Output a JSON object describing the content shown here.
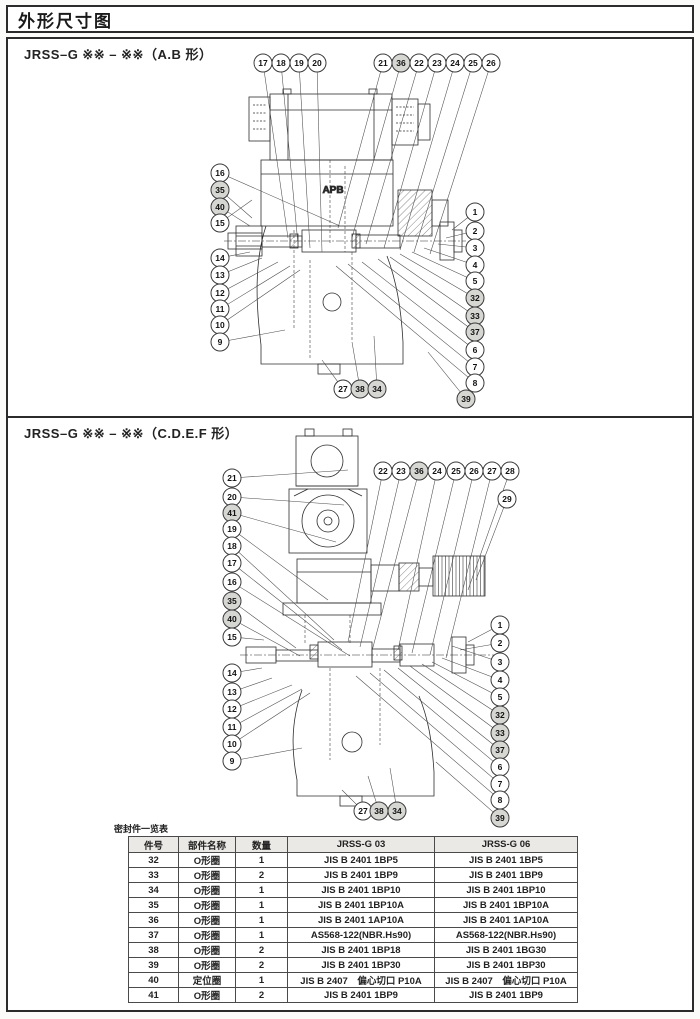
{
  "page_title": "外形尺寸图",
  "sections": [
    {
      "heading": "JRSS–G ※※ – ※※（A.B 形）",
      "drawing_label": "APB",
      "callouts": [
        {
          "n": "17",
          "x": 263,
          "y": 63,
          "tx": 288,
          "ty": 238
        },
        {
          "n": "18",
          "x": 281,
          "y": 63,
          "tx": 298,
          "ty": 244
        },
        {
          "n": "19",
          "x": 299,
          "y": 63,
          "tx": 310,
          "ty": 248
        },
        {
          "n": "20",
          "x": 317,
          "y": 63,
          "tx": 322,
          "ty": 252
        },
        {
          "n": "21",
          "x": 383,
          "y": 63,
          "tx": 338,
          "ty": 228
        },
        {
          "n": "36",
          "x": 401,
          "y": 63,
          "tx": 352,
          "ty": 238,
          "s": true
        },
        {
          "n": "22",
          "x": 419,
          "y": 63,
          "tx": 366,
          "ty": 244
        },
        {
          "n": "23",
          "x": 437,
          "y": 63,
          "tx": 384,
          "ty": 248
        },
        {
          "n": "24",
          "x": 455,
          "y": 63,
          "tx": 400,
          "ty": 250
        },
        {
          "n": "25",
          "x": 473,
          "y": 63,
          "tx": 414,
          "ty": 252
        },
        {
          "n": "26",
          "x": 491,
          "y": 63,
          "tx": 430,
          "ty": 254
        },
        {
          "n": "16",
          "x": 220,
          "y": 173,
          "tx": 340,
          "ty": 226
        },
        {
          "n": "35",
          "x": 220,
          "y": 190,
          "tx": 252,
          "ty": 218,
          "s": true
        },
        {
          "n": "40",
          "x": 220,
          "y": 207,
          "tx": 250,
          "ty": 226,
          "s": true
        },
        {
          "n": "15",
          "x": 220,
          "y": 223,
          "tx": 252,
          "ty": 200
        },
        {
          "n": "14",
          "x": 220,
          "y": 258,
          "tx": 250,
          "ty": 252
        },
        {
          "n": "13",
          "x": 220,
          "y": 275,
          "tx": 262,
          "ty": 258
        },
        {
          "n": "12",
          "x": 220,
          "y": 293,
          "tx": 278,
          "ty": 262
        },
        {
          "n": "11",
          "x": 220,
          "y": 309,
          "tx": 290,
          "ty": 266
        },
        {
          "n": "10",
          "x": 220,
          "y": 325,
          "tx": 300,
          "ty": 270
        },
        {
          "n": "9",
          "x": 220,
          "y": 342,
          "tx": 285,
          "ty": 330
        },
        {
          "n": "1",
          "x": 475,
          "y": 212,
          "tx": 452,
          "ty": 230
        },
        {
          "n": "2",
          "x": 475,
          "y": 231,
          "tx": 446,
          "ty": 238
        },
        {
          "n": "3",
          "x": 475,
          "y": 248,
          "tx": 438,
          "ty": 244
        },
        {
          "n": "4",
          "x": 475,
          "y": 265,
          "tx": 424,
          "ty": 248
        },
        {
          "n": "5",
          "x": 475,
          "y": 281,
          "tx": 412,
          "ty": 252
        },
        {
          "n": "32",
          "x": 475,
          "y": 298,
          "tx": 400,
          "ty": 254,
          "s": true
        },
        {
          "n": "33",
          "x": 475,
          "y": 316,
          "tx": 390,
          "ty": 257,
          "s": true
        },
        {
          "n": "37",
          "x": 475,
          "y": 332,
          "tx": 378,
          "ty": 259,
          "s": true
        },
        {
          "n": "6",
          "x": 475,
          "y": 350,
          "tx": 362,
          "ty": 262
        },
        {
          "n": "7",
          "x": 475,
          "y": 367,
          "tx": 348,
          "ty": 264
        },
        {
          "n": "8",
          "x": 475,
          "y": 383,
          "tx": 336,
          "ty": 266
        },
        {
          "n": "39",
          "x": 466,
          "y": 399,
          "tx": 428,
          "ty": 352,
          "s": true
        },
        {
          "n": "27",
          "x": 343,
          "y": 389,
          "tx": 322,
          "ty": 360
        },
        {
          "n": "38",
          "x": 360,
          "y": 389,
          "tx": 352,
          "ty": 342,
          "s": true
        },
        {
          "n": "34",
          "x": 377,
          "y": 389,
          "tx": 374,
          "ty": 336,
          "s": true
        }
      ]
    },
    {
      "heading": "JRSS–G ※※ – ※※（C.D.E.F 形）",
      "callouts": [
        {
          "n": "22",
          "x": 383,
          "y": 471,
          "tx": 348,
          "ty": 642
        },
        {
          "n": "23",
          "x": 401,
          "y": 471,
          "tx": 360,
          "ty": 647
        },
        {
          "n": "36",
          "x": 419,
          "y": 471,
          "tx": 372,
          "ty": 651,
          "s": true
        },
        {
          "n": "24",
          "x": 437,
          "y": 471,
          "tx": 398,
          "ty": 650
        },
        {
          "n": "25",
          "x": 456,
          "y": 471,
          "tx": 412,
          "ty": 653
        },
        {
          "n": "26",
          "x": 474,
          "y": 471,
          "tx": 430,
          "ty": 655
        },
        {
          "n": "27",
          "x": 492,
          "y": 471,
          "tx": 446,
          "ty": 658
        },
        {
          "n": "28",
          "x": 510,
          "y": 471,
          "tx": 468,
          "ty": 590
        },
        {
          "n": "29",
          "x": 507,
          "y": 499,
          "tx": 476,
          "ty": 580
        },
        {
          "n": "21",
          "x": 232,
          "y": 478,
          "tx": 348,
          "ty": 470
        },
        {
          "n": "20",
          "x": 232,
          "y": 497,
          "tx": 344,
          "ty": 505
        },
        {
          "n": "41",
          "x": 232,
          "y": 513,
          "tx": 336,
          "ty": 542,
          "s": true
        },
        {
          "n": "19",
          "x": 232,
          "y": 529,
          "tx": 328,
          "ty": 600
        },
        {
          "n": "18",
          "x": 232,
          "y": 546,
          "tx": 334,
          "ty": 640
        },
        {
          "n": "17",
          "x": 232,
          "y": 563,
          "tx": 342,
          "ty": 650
        },
        {
          "n": "16",
          "x": 232,
          "y": 582,
          "tx": 350,
          "ty": 656
        },
        {
          "n": "35",
          "x": 232,
          "y": 601,
          "tx": 296,
          "ty": 648,
          "s": true
        },
        {
          "n": "40",
          "x": 232,
          "y": 619,
          "tx": 300,
          "ty": 656,
          "s": true
        },
        {
          "n": "15",
          "x": 232,
          "y": 637,
          "tx": 264,
          "ty": 640
        },
        {
          "n": "14",
          "x": 232,
          "y": 673,
          "tx": 262,
          "ty": 668
        },
        {
          "n": "13",
          "x": 232,
          "y": 692,
          "tx": 272,
          "ty": 678
        },
        {
          "n": "12",
          "x": 232,
          "y": 709,
          "tx": 292,
          "ty": 685
        },
        {
          "n": "11",
          "x": 232,
          "y": 727,
          "tx": 302,
          "ty": 689
        },
        {
          "n": "10",
          "x": 232,
          "y": 744,
          "tx": 310,
          "ty": 693
        },
        {
          "n": "9",
          "x": 232,
          "y": 761,
          "tx": 302,
          "ty": 748
        },
        {
          "n": "1",
          "x": 500,
          "y": 625,
          "tx": 468,
          "ty": 642
        },
        {
          "n": "2",
          "x": 500,
          "y": 643,
          "tx": 460,
          "ty": 650
        },
        {
          "n": "3",
          "x": 500,
          "y": 662,
          "tx": 452,
          "ty": 646
        },
        {
          "n": "4",
          "x": 500,
          "y": 680,
          "tx": 442,
          "ty": 658
        },
        {
          "n": "5",
          "x": 500,
          "y": 697,
          "tx": 432,
          "ty": 662
        },
        {
          "n": "32",
          "x": 500,
          "y": 715,
          "tx": 422,
          "ty": 664,
          "s": true
        },
        {
          "n": "33",
          "x": 500,
          "y": 733,
          "tx": 410,
          "ty": 666,
          "s": true
        },
        {
          "n": "37",
          "x": 500,
          "y": 750,
          "tx": 398,
          "ty": 668,
          "s": true
        },
        {
          "n": "6",
          "x": 500,
          "y": 767,
          "tx": 384,
          "ty": 670
        },
        {
          "n": "7",
          "x": 500,
          "y": 784,
          "tx": 370,
          "ty": 673
        },
        {
          "n": "8",
          "x": 500,
          "y": 800,
          "tx": 356,
          "ty": 676
        },
        {
          "n": "39",
          "x": 500,
          "y": 818,
          "tx": 436,
          "ty": 762,
          "s": true
        },
        {
          "n": "27",
          "x": 363,
          "y": 811,
          "tx": 342,
          "ty": 790
        },
        {
          "n": "38",
          "x": 379,
          "y": 811,
          "tx": 368,
          "ty": 776,
          "s": true
        },
        {
          "n": "34",
          "x": 397,
          "y": 811,
          "tx": 390,
          "ty": 768,
          "s": true
        }
      ]
    }
  ],
  "seal_table": {
    "caption": "密封件一览表",
    "columns": [
      "件号",
      "部件名称",
      "数量",
      "JRSS-G 03",
      "JRSS-G 06"
    ],
    "rows": [
      [
        "32",
        "O形圈",
        "1",
        "JIS B 2401 1BP5",
        "JIS B 2401 1BP5"
      ],
      [
        "33",
        "O形圈",
        "2",
        "JIS B 2401 1BP9",
        "JIS B 2401 1BP9"
      ],
      [
        "34",
        "O形圈",
        "1",
        "JIS B 2401 1BP10",
        "JIS B 2401 1BP10"
      ],
      [
        "35",
        "O形圈",
        "1",
        "JIS B 2401 1BP10A",
        "JIS B 2401 1BP10A"
      ],
      [
        "36",
        "O形圈",
        "1",
        "JIS B 2401 1AP10A",
        "JIS B 2401 1AP10A"
      ],
      [
        "37",
        "O形圈",
        "1",
        "AS568-122(NBR.Hs90)",
        "AS568-122(NBR.Hs90)"
      ],
      [
        "38",
        "O形圈",
        "2",
        "JIS B 2401 1BP18",
        "JIS B 2401 1BG30"
      ],
      [
        "39",
        "O形圈",
        "2",
        "JIS B 2401 1BP30",
        "JIS B 2401 1BP30"
      ],
      [
        "40",
        "定位圈",
        "1",
        "JIS B 2407　偏心切口 P10A",
        "JIS B 2407　偏心切口 P10A"
      ],
      [
        "41",
        "O形圈",
        "2",
        "JIS B 2401 1BP9",
        "JIS B 2401 1BP9"
      ]
    ]
  }
}
